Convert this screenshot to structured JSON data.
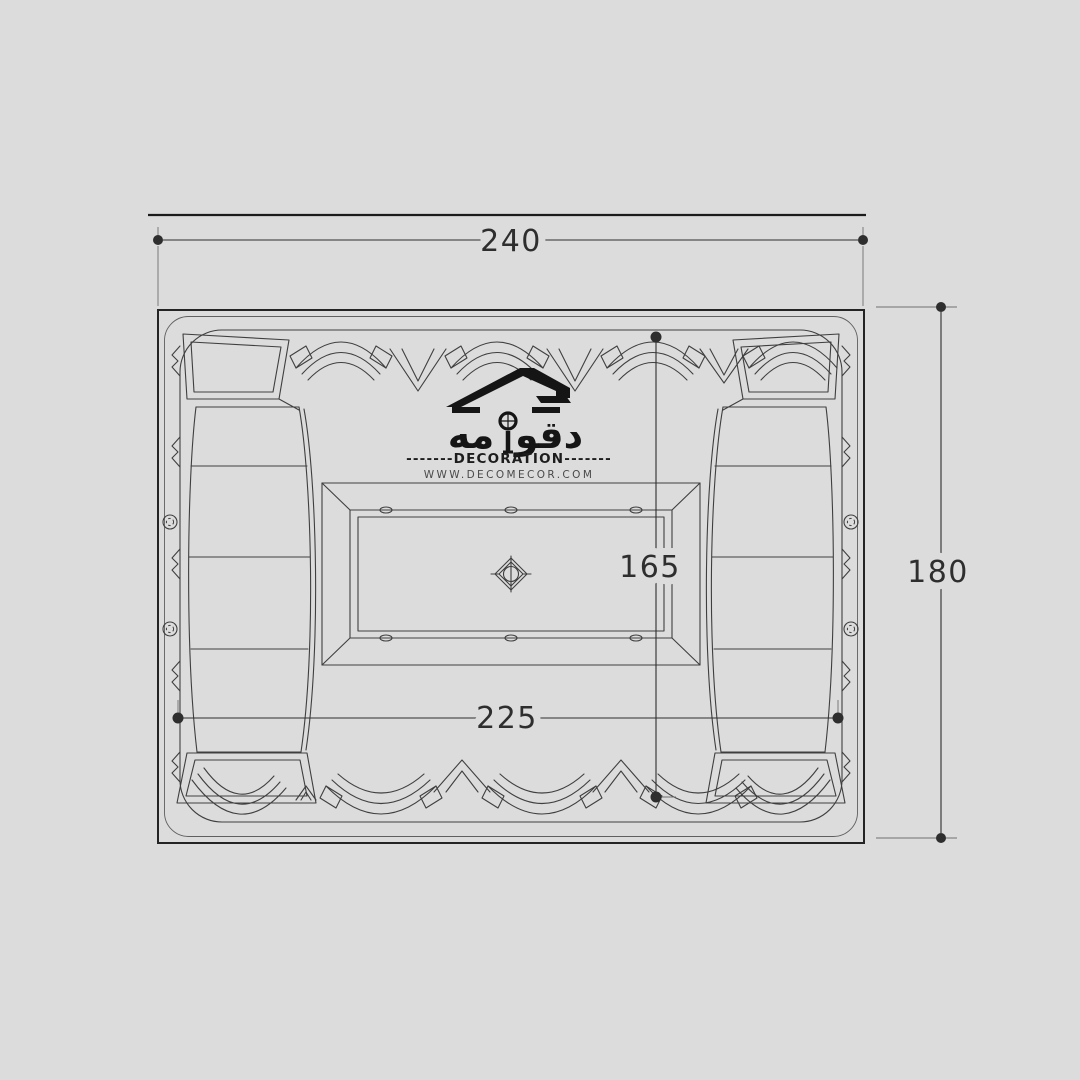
{
  "colors": {
    "bg": "#dcdcdc",
    "line": "#3f3f3f",
    "dim": "#2e2e2e",
    "logo": "#151515",
    "muted": "#4a4a4a"
  },
  "dimensions": {
    "top": "240",
    "right": "180",
    "inner_vertical": "165",
    "inner_horizontal": "225"
  },
  "logo": {
    "arabic_right": "دقو",
    "arabic_left": "مه",
    "decoration_line": "-------DECORATION-------",
    "website": "WWW.DECOMECOR.COM"
  }
}
